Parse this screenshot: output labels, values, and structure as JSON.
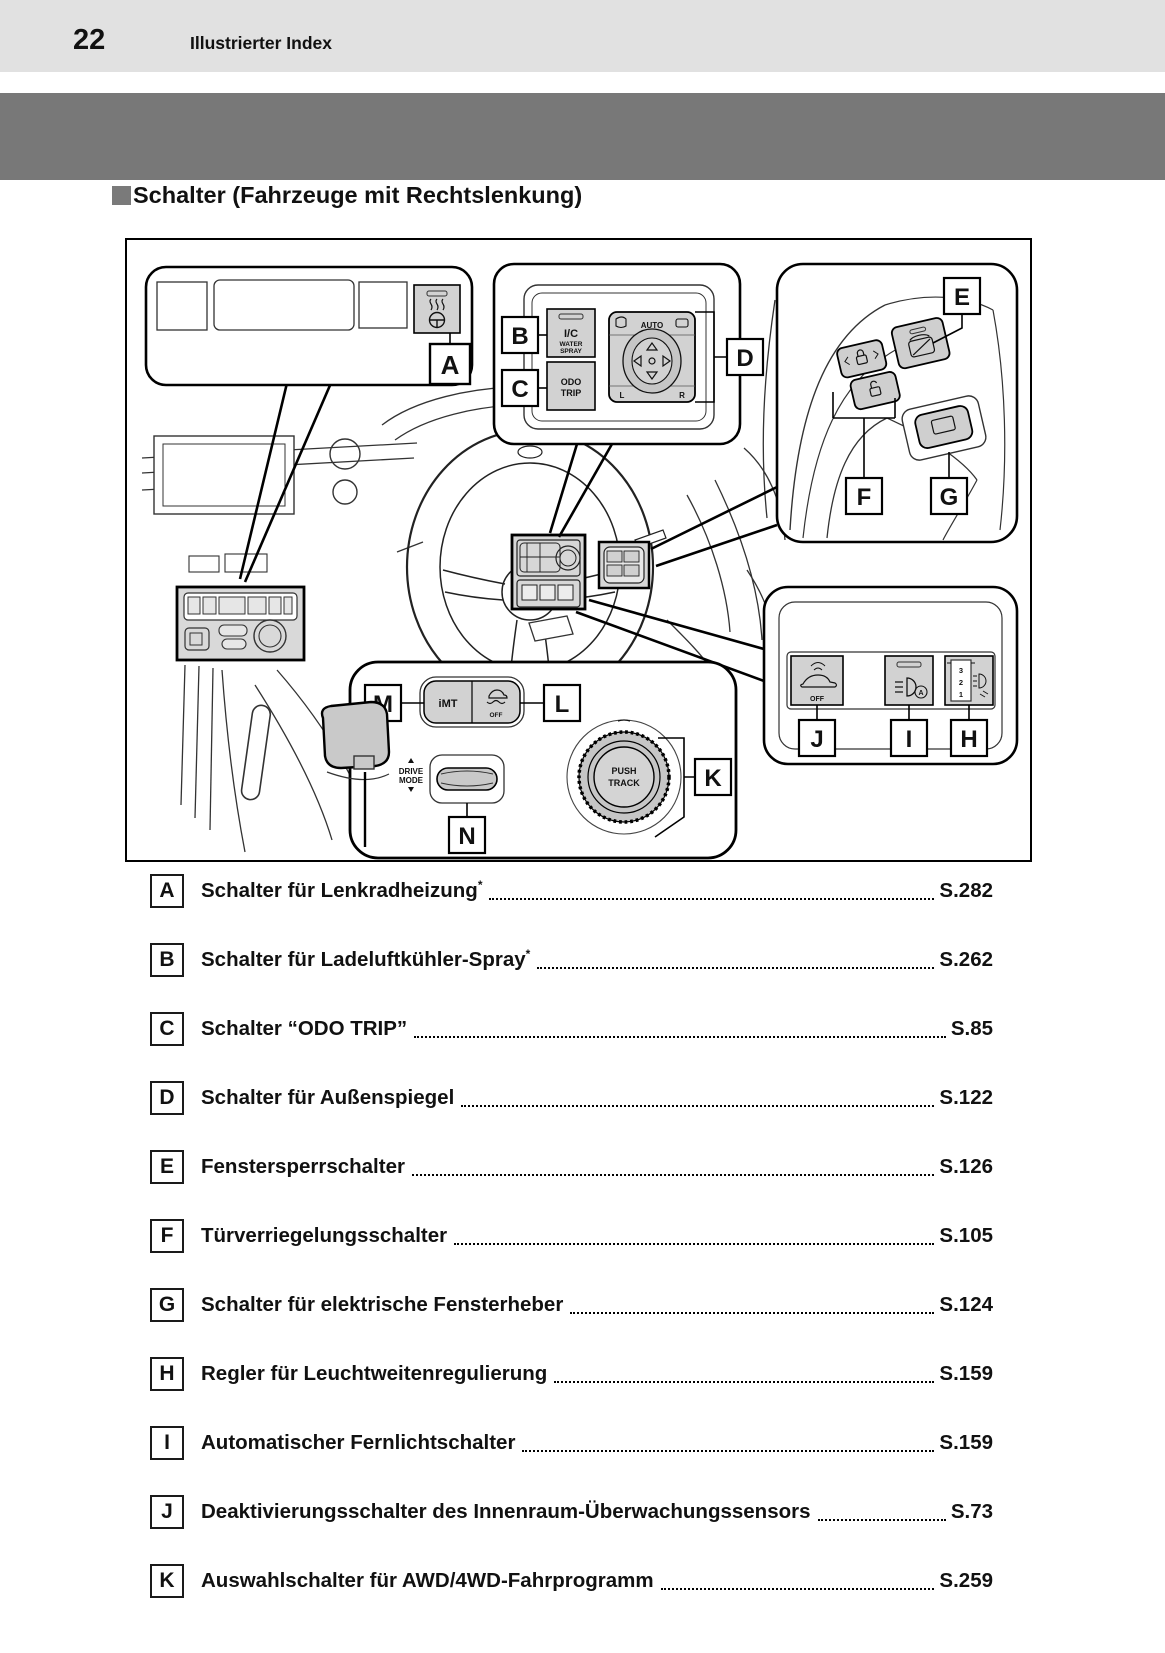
{
  "header": {
    "page_number": "22",
    "title": "Illustrierter Index"
  },
  "section": {
    "title": "Schalter (Fahrzeuge mit Rechtslenkung)"
  },
  "colors": {
    "header_bg": "#e1e1e1",
    "band_gray": "#787878",
    "panel_fill": "#d2d2d2",
    "highlight_fill": "#d7d7d7"
  },
  "figure": {
    "callouts": {
      "A": "A",
      "B": "B",
      "C": "C",
      "D": "D",
      "E": "E",
      "F": "F",
      "G": "G",
      "H": "H",
      "I": "I",
      "J": "J",
      "K": "K",
      "L": "L",
      "M": "M",
      "N": "N"
    },
    "texts": {
      "ic": "I/C",
      "water": "WATER",
      "spray": "SPRAY",
      "odo": "ODO",
      "trip": "TRIP",
      "auto": "AUTO",
      "mirror_left": "L",
      "mirror_right": "R",
      "imt": "iMT",
      "vsc_off": "OFF",
      "drive": "DRIVE",
      "mode": "MODE",
      "push": "PUSH",
      "track": "TRACK",
      "sensor_off": "OFF",
      "level3": "3",
      "level2": "2",
      "level1": "1"
    }
  },
  "index": {
    "rows": [
      {
        "letter": "A",
        "label": "Schalter für Lenkradheizung",
        "asterisk": true,
        "page": "S.282"
      },
      {
        "letter": "B",
        "label": "Schalter für Ladeluftkühler-Spray",
        "asterisk": true,
        "page": "S.262"
      },
      {
        "letter": "C",
        "label": "Schalter “ODO TRIP”",
        "asterisk": false,
        "page": "S.85"
      },
      {
        "letter": "D",
        "label": "Schalter für Außenspiegel",
        "asterisk": false,
        "page": "S.122"
      },
      {
        "letter": "E",
        "label": "Fenstersperrschalter",
        "asterisk": false,
        "page": "S.126"
      },
      {
        "letter": "F",
        "label": "Türverriegelungsschalter",
        "asterisk": false,
        "page": "S.105"
      },
      {
        "letter": "G",
        "label": "Schalter für elektrische Fensterheber",
        "asterisk": false,
        "page": "S.124"
      },
      {
        "letter": "H",
        "label": "Regler für Leuchtweitenregulierung",
        "asterisk": false,
        "page": "S.159"
      },
      {
        "letter": "I",
        "label": "Automatischer Fernlichtschalter",
        "asterisk": false,
        "page": "S.159"
      },
      {
        "letter": "J",
        "label": "Deaktivierungsschalter des Innenraum-Überwachungssensors",
        "asterisk": false,
        "page": "S.73"
      },
      {
        "letter": "K",
        "label": "Auswahlschalter für AWD/4WD-Fahrprogramm",
        "asterisk": false,
        "page": "S.259"
      }
    ]
  }
}
